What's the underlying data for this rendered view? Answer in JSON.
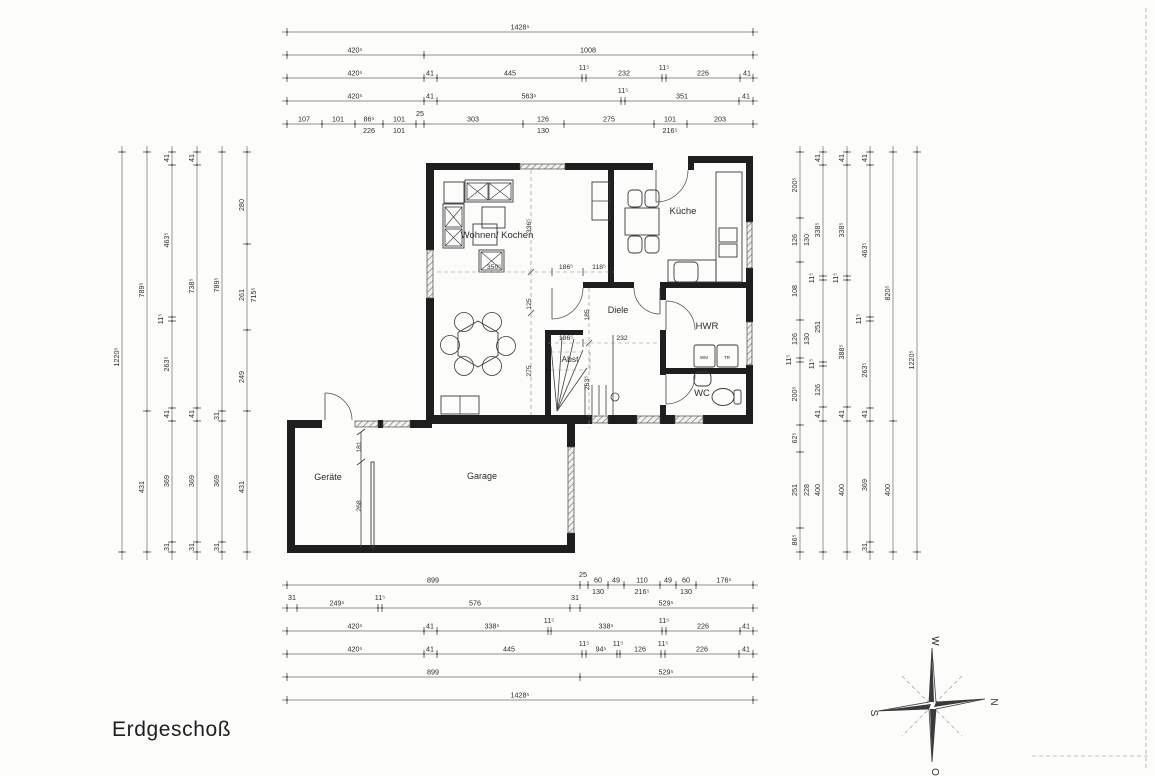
{
  "title": "Erdgeschoß",
  "compass": {
    "north": "N",
    "east": "O",
    "south": "S",
    "west": "W"
  },
  "rooms": [
    {
      "id": "wohnen-kochen",
      "label": "Wohnen/ Kochen",
      "x": 497,
      "y": 238,
      "size": 9.5
    },
    {
      "id": "kueche",
      "label": "Küche",
      "x": 683,
      "y": 214,
      "size": 9.5
    },
    {
      "id": "diele",
      "label": "Diele",
      "x": 618,
      "y": 313,
      "size": 9
    },
    {
      "id": "hwr",
      "label": "HWR",
      "x": 707,
      "y": 329,
      "size": 9.5
    },
    {
      "id": "wc",
      "label": "WC",
      "x": 702,
      "y": 396,
      "size": 9.5
    },
    {
      "id": "abst",
      "label": "Abst",
      "x": 570,
      "y": 362,
      "size": 8.5
    },
    {
      "id": "geraete",
      "label": "Geräte",
      "x": 328,
      "y": 480,
      "size": 9
    },
    {
      "id": "garage",
      "label": "Garage",
      "x": 482,
      "y": 479,
      "size": 9
    },
    {
      "id": "wm",
      "label": "WM",
      "x": 704,
      "y": 359,
      "size": 4.5
    },
    {
      "id": "tr",
      "label": "TR",
      "x": 727,
      "y": 359,
      "size": 4.5
    }
  ],
  "dim_chains": [
    {
      "id": "top-1",
      "axis": "h",
      "pos": 32,
      "from": 287,
      "to": 753,
      "ticks": [
        287,
        753
      ],
      "labels": [
        {
          "at": 520,
          "t": "1428⁵"
        }
      ]
    },
    {
      "id": "top-2",
      "axis": "h",
      "pos": 55,
      "from": 287,
      "to": 753,
      "ticks": [
        287,
        424,
        753
      ],
      "labels": [
        {
          "at": 355,
          "t": "420⁵"
        },
        {
          "at": 588,
          "t": "1008"
        }
      ]
    },
    {
      "id": "top-3",
      "axis": "h",
      "pos": 78,
      "from": 287,
      "to": 753,
      "ticks": [
        287,
        424,
        437,
        582,
        586,
        662,
        666,
        740,
        753
      ],
      "labels": [
        {
          "at": 355,
          "t": "420⁵"
        },
        {
          "at": 430,
          "t": "41"
        },
        {
          "at": 510,
          "t": "445"
        },
        {
          "at": 584,
          "t": "11⁵",
          "raise": true
        },
        {
          "at": 624,
          "t": "232"
        },
        {
          "at": 664,
          "t": "11⁵",
          "raise": true
        },
        {
          "at": 703,
          "t": "226"
        },
        {
          "at": 747,
          "t": "41"
        }
      ]
    },
    {
      "id": "top-4",
      "axis": "h",
      "pos": 101,
      "from": 287,
      "to": 753,
      "ticks": [
        287,
        424,
        437,
        621,
        625,
        739,
        753
      ],
      "labels": [
        {
          "at": 355,
          "t": "420⁵"
        },
        {
          "at": 430,
          "t": "41"
        },
        {
          "at": 529,
          "t": "563⁵"
        },
        {
          "at": 623,
          "t": "11⁵",
          "raise": true
        },
        {
          "at": 682,
          "t": "351"
        },
        {
          "at": 746,
          "t": "41"
        }
      ]
    },
    {
      "id": "top-5",
      "axis": "h",
      "pos": 124,
      "from": 287,
      "to": 753,
      "ticks": [
        287,
        322,
        355,
        383,
        416,
        424,
        523,
        564,
        654,
        687,
        753
      ],
      "labels": [
        {
          "at": 304,
          "t": "107"
        },
        {
          "at": 338,
          "t": "101"
        },
        {
          "at": 369,
          "t": "86⁵",
          "sub": "226"
        },
        {
          "at": 399,
          "t": "101",
          "sub": "101"
        },
        {
          "at": 420,
          "t": "25",
          "raise": true
        },
        {
          "at": 473,
          "t": "303"
        },
        {
          "at": 543,
          "t": "126",
          "sub": "130"
        },
        {
          "at": 609,
          "t": "275"
        },
        {
          "at": 670,
          "t": "101",
          "sub": "216⁵"
        },
        {
          "at": 720,
          "t": "203"
        }
      ]
    },
    {
      "id": "bottom-1",
      "axis": "h",
      "pos": 585,
      "from": 287,
      "to": 753,
      "ticks": [
        287,
        580,
        588,
        608,
        624,
        660,
        676,
        696,
        753
      ],
      "labels": [
        {
          "at": 433,
          "t": "899"
        },
        {
          "at": 583,
          "t": "25",
          "raise": true
        },
        {
          "at": 598,
          "t": "60",
          "sub": "130"
        },
        {
          "at": 616,
          "t": "49"
        },
        {
          "at": 642,
          "t": "110",
          "sub": "216⁵"
        },
        {
          "at": 668,
          "t": "49"
        },
        {
          "at": 686,
          "t": "60",
          "sub": "130"
        },
        {
          "at": 724,
          "t": "176⁵"
        }
      ]
    },
    {
      "id": "bottom-2",
      "axis": "h",
      "pos": 608,
      "from": 287,
      "to": 753,
      "ticks": [
        287,
        297,
        378,
        382,
        570,
        580,
        753
      ],
      "labels": [
        {
          "at": 292,
          "t": "31",
          "raise": true
        },
        {
          "at": 337,
          "t": "249⁵"
        },
        {
          "at": 380,
          "t": "11⁵",
          "raise": true
        },
        {
          "at": 475,
          "t": "576"
        },
        {
          "at": 575,
          "t": "31",
          "raise": true
        },
        {
          "at": 666,
          "t": "529⁵"
        }
      ]
    },
    {
      "id": "bottom-3",
      "axis": "h",
      "pos": 631,
      "from": 287,
      "to": 753,
      "ticks": [
        287,
        424,
        437,
        548,
        551,
        662,
        666,
        740,
        753
      ],
      "labels": [
        {
          "at": 355,
          "t": "420⁵"
        },
        {
          "at": 430,
          "t": "41"
        },
        {
          "at": 492,
          "t": "338⁵"
        },
        {
          "at": 549,
          "t": "11⁵",
          "raise": true
        },
        {
          "at": 606,
          "t": "338⁵"
        },
        {
          "at": 664,
          "t": "11⁵",
          "raise": true
        },
        {
          "at": 703,
          "t": "226"
        },
        {
          "at": 746,
          "t": "41"
        }
      ]
    },
    {
      "id": "bottom-4",
      "axis": "h",
      "pos": 654,
      "from": 287,
      "to": 753,
      "ticks": [
        287,
        424,
        437,
        582,
        586,
        617,
        620,
        661,
        665,
        739,
        753
      ],
      "labels": [
        {
          "at": 355,
          "t": "420⁵"
        },
        {
          "at": 430,
          "t": "41"
        },
        {
          "at": 509,
          "t": "445"
        },
        {
          "at": 584,
          "t": "11⁵",
          "raise": true
        },
        {
          "at": 601,
          "t": "94⁵"
        },
        {
          "at": 618,
          "t": "11⁵",
          "raise": true
        },
        {
          "at": 640,
          "t": "126"
        },
        {
          "at": 663,
          "t": "11⁵",
          "raise": true
        },
        {
          "at": 702,
          "t": "226"
        },
        {
          "at": 746,
          "t": "41"
        }
      ]
    },
    {
      "id": "bottom-5",
      "axis": "h",
      "pos": 677,
      "from": 287,
      "to": 753,
      "ticks": [
        287,
        580,
        753
      ],
      "labels": [
        {
          "at": 433,
          "t": "899"
        },
        {
          "at": 666,
          "t": "529⁵"
        }
      ]
    },
    {
      "id": "bottom-6",
      "axis": "h",
      "pos": 700,
      "from": 287,
      "to": 753,
      "ticks": [
        287,
        753
      ],
      "labels": [
        {
          "at": 520,
          "t": "1428⁵"
        }
      ]
    },
    {
      "id": "left-1",
      "axis": "v",
      "pos": 122,
      "from": 152,
      "to": 552,
      "ticks": [
        152,
        552
      ],
      "labels": [
        {
          "at": 357,
          "t": "1220⁵"
        }
      ]
    },
    {
      "id": "left-2",
      "axis": "v",
      "pos": 147,
      "from": 152,
      "to": 552,
      "ticks": [
        152,
        411,
        552
      ],
      "labels": [
        {
          "at": 290,
          "t": "789⁵"
        },
        {
          "at": 487,
          "t": "431"
        }
      ]
    },
    {
      "id": "left-3",
      "axis": "v",
      "pos": 172,
      "from": 152,
      "to": 552,
      "ticks": [
        152,
        165,
        317,
        321,
        408,
        421,
        542,
        552
      ],
      "labels": [
        {
          "at": 158,
          "t": "41"
        },
        {
          "at": 240,
          "t": "463⁵"
        },
        {
          "at": 319,
          "t": "11⁵",
          "raise": true
        },
        {
          "at": 364,
          "t": "263⁵"
        },
        {
          "at": 414,
          "t": "41"
        },
        {
          "at": 481,
          "t": "369"
        },
        {
          "at": 547,
          "t": "31"
        }
      ]
    },
    {
      "id": "left-4",
      "axis": "v",
      "pos": 197,
      "from": 152,
      "to": 552,
      "ticks": [
        152,
        165,
        408,
        421,
        542,
        552
      ],
      "labels": [
        {
          "at": 158,
          "t": "41"
        },
        {
          "at": 286,
          "t": "738⁵"
        },
        {
          "at": 414,
          "t": "41"
        },
        {
          "at": 481,
          "t": "369"
        },
        {
          "at": 547,
          "t": "31"
        }
      ]
    },
    {
      "id": "left-5",
      "axis": "v",
      "pos": 222,
      "from": 152,
      "to": 552,
      "ticks": [
        152,
        411,
        421,
        542,
        552
      ],
      "labels": [
        {
          "at": 285,
          "t": "789⁵"
        },
        {
          "at": 416,
          "t": "31"
        },
        {
          "at": 481,
          "t": "369"
        },
        {
          "at": 547,
          "t": "31"
        }
      ]
    },
    {
      "id": "left-6",
      "axis": "v",
      "pos": 247,
      "from": 152,
      "to": 552,
      "ticks": [
        152,
        244,
        330,
        411,
        552
      ],
      "labels": [
        {
          "at": 205,
          "t": "280"
        },
        {
          "at": 295,
          "t": "261",
          "sub": "715⁵"
        },
        {
          "at": 377,
          "t": "249"
        },
        {
          "at": 487,
          "t": "431"
        }
      ]
    },
    {
      "id": "right-1",
      "axis": "v",
      "pos": 800,
      "from": 152,
      "to": 552,
      "ticks": [
        152,
        218,
        262,
        320,
        358,
        362,
        425,
        452,
        528,
        552
      ],
      "labels": [
        {
          "at": 185,
          "t": "200⁵"
        },
        {
          "at": 240,
          "t": "126",
          "sub": "130"
        },
        {
          "at": 291,
          "t": "108"
        },
        {
          "at": 339,
          "t": "126",
          "sub": "130"
        },
        {
          "at": 360,
          "t": "11⁵",
          "raise": true
        },
        {
          "at": 394,
          "t": "200⁵"
        },
        {
          "at": 438,
          "t": "62⁵"
        },
        {
          "at": 490,
          "t": "251",
          "sub": "228"
        },
        {
          "at": 540,
          "t": "86⁵"
        }
      ]
    },
    {
      "id": "right-2",
      "axis": "v",
      "pos": 823,
      "from": 152,
      "to": 552,
      "ticks": [
        152,
        165,
        276,
        280,
        362,
        366,
        407,
        421,
        552
      ],
      "labels": [
        {
          "at": 158,
          "t": "41"
        },
        {
          "at": 230,
          "t": "338⁵"
        },
        {
          "at": 278,
          "t": "11⁵",
          "raise": true
        },
        {
          "at": 327,
          "t": "251"
        },
        {
          "at": 364,
          "t": "11⁵",
          "raise": true
        },
        {
          "at": 390,
          "t": "126"
        },
        {
          "at": 414,
          "t": "41"
        },
        {
          "at": 490,
          "t": "400"
        }
      ]
    },
    {
      "id": "right-3",
      "axis": "v",
      "pos": 847,
      "from": 152,
      "to": 552,
      "ticks": [
        152,
        165,
        276,
        280,
        407,
        421,
        552
      ],
      "labels": [
        {
          "at": 158,
          "t": "41"
        },
        {
          "at": 230,
          "t": "338⁵"
        },
        {
          "at": 278,
          "t": "11⁵",
          "raise": true
        },
        {
          "at": 352,
          "t": "388⁵"
        },
        {
          "at": 414,
          "t": "41"
        },
        {
          "at": 490,
          "t": "400"
        }
      ]
    },
    {
      "id": "right-4",
      "axis": "v",
      "pos": 870,
      "from": 152,
      "to": 552,
      "ticks": [
        152,
        165,
        317,
        321,
        408,
        421,
        542,
        552
      ],
      "labels": [
        {
          "at": 158,
          "t": "41"
        },
        {
          "at": 250,
          "t": "463⁵"
        },
        {
          "at": 319,
          "t": "11⁵",
          "raise": true
        },
        {
          "at": 370,
          "t": "263⁵"
        },
        {
          "at": 414,
          "t": "41"
        },
        {
          "at": 485,
          "t": "369"
        },
        {
          "at": 547,
          "t": "31"
        }
      ]
    },
    {
      "id": "right-5",
      "axis": "v",
      "pos": 893,
      "from": 152,
      "to": 552,
      "ticks": [
        152,
        421,
        552
      ],
      "labels": [
        {
          "at": 293,
          "t": "820⁵"
        },
        {
          "at": 490,
          "t": "400"
        }
      ]
    },
    {
      "id": "right-6",
      "axis": "v",
      "pos": 917,
      "from": 152,
      "to": 552,
      "ticks": [
        152,
        552
      ],
      "labels": [
        {
          "at": 360,
          "t": "1220⁵"
        }
      ]
    }
  ],
  "inner_dims": [
    {
      "x": 531,
      "y": 226,
      "t": "336⁵",
      "rot": true
    },
    {
      "x": 531,
      "y": 304,
      "t": "125",
      "rot": true
    },
    {
      "x": 531,
      "y": 371,
      "t": "275",
      "rot": true
    },
    {
      "x": 494,
      "y": 269,
      "t": "350⁵"
    },
    {
      "x": 566,
      "y": 269,
      "t": "186⁵"
    },
    {
      "x": 599,
      "y": 269,
      "t": "118⁵"
    },
    {
      "x": 589,
      "y": 315,
      "t": "185",
      "rot": true
    },
    {
      "x": 589,
      "y": 383,
      "t": "263⁵",
      "rot": true
    },
    {
      "x": 566,
      "y": 340,
      "t": "186⁵"
    },
    {
      "x": 622,
      "y": 340,
      "t": "232"
    },
    {
      "x": 361,
      "y": 447,
      "t": "181",
      "rot": true
    },
    {
      "x": 361,
      "y": 506,
      "t": "268",
      "rot": true
    }
  ]
}
